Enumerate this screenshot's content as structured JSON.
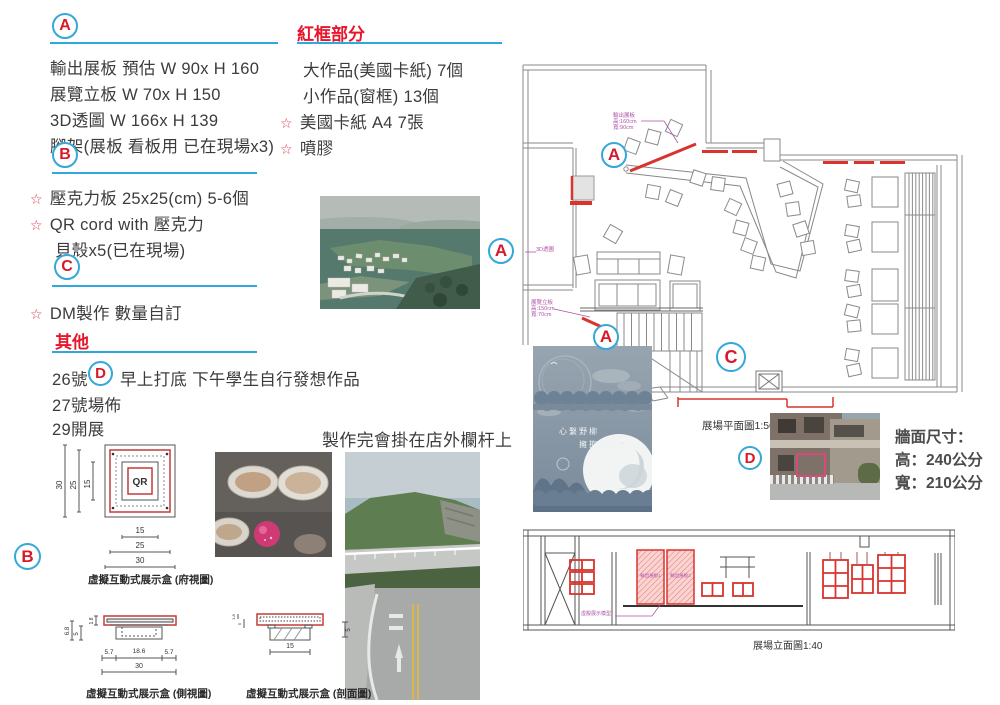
{
  "badges": {
    "a": "A",
    "b": "B",
    "c": "C",
    "d": "D"
  },
  "colors": {
    "accent_blue": "#2ea9dc",
    "accent_red": "#d6192b",
    "annotation_magenta": "#b052a8",
    "red_line": "#d9332e"
  },
  "section_a": {
    "items": [
      "輸出展板 預估 W 90x H 160",
      "展覽立板 W 70x H 150",
      "3D透圖 W 166x H 139",
      "腳架(展板 看板用 已在現場x3)"
    ]
  },
  "section_b": {
    "starred": [
      "壓克力板 25x25(cm) 5-6個",
      "QR cord with 壓克力"
    ],
    "plain": "貝殼x5(已在現場)"
  },
  "section_c": {
    "starred": [
      "DM製作 數量自訂"
    ]
  },
  "others": {
    "title": "其他",
    "line1_pre": "26號",
    "line1_post": "早上打底 下午學生自行發想作品",
    "line2": "27號場佈",
    "line3": "29開展"
  },
  "red_frame": {
    "title": "紅框部分",
    "items": [
      "大作品(美國卡紙) 7個",
      "小作品(窗框) 13個"
    ],
    "starred": [
      "美國卡紙 A4 7張",
      "噴膠"
    ]
  },
  "mid_caption": "製作完會掛在店外欄杆上",
  "plan": {
    "caption": "展場平面圖1:50",
    "ann_board": [
      "輸出展板",
      "高:160cm",
      "寬:90cm"
    ],
    "ann_3d": "3D透圖",
    "ann_stand": [
      "展覽立板",
      "高:150cm",
      "寬:70cm"
    ]
  },
  "wall_size": {
    "l1": "牆面尺寸：",
    "l2": "高：240公分",
    "l3": "寬：210公分"
  },
  "elevation": {
    "caption": "展場立面圖1:40",
    "panel1": "輸出展板1",
    "panel2": "輸出展板2",
    "note": "虛擬展示模型"
  },
  "poster": {
    "line1": "心繫野柳",
    "line2": "擁抱萬里"
  },
  "qr_box": {
    "qr": "QR",
    "top": {
      "caption": "虛擬互動式展示盒 (府視圖)",
      "v": [
        "30",
        "25",
        "15"
      ],
      "h": [
        "15",
        "25",
        "30"
      ]
    },
    "side": {
      "caption": "虛擬互動式展示盒 (側視圖)",
      "left": [
        "6.8",
        "5",
        "1.8"
      ],
      "h": [
        "5.7",
        "18.6",
        "5.7"
      ],
      "total": "30"
    },
    "sec": {
      "caption": "虛擬互動式展示盒 (剖面圖)",
      "left": [
        "1.8",
        "5"
      ],
      "right": "5",
      "h": "15"
    }
  }
}
